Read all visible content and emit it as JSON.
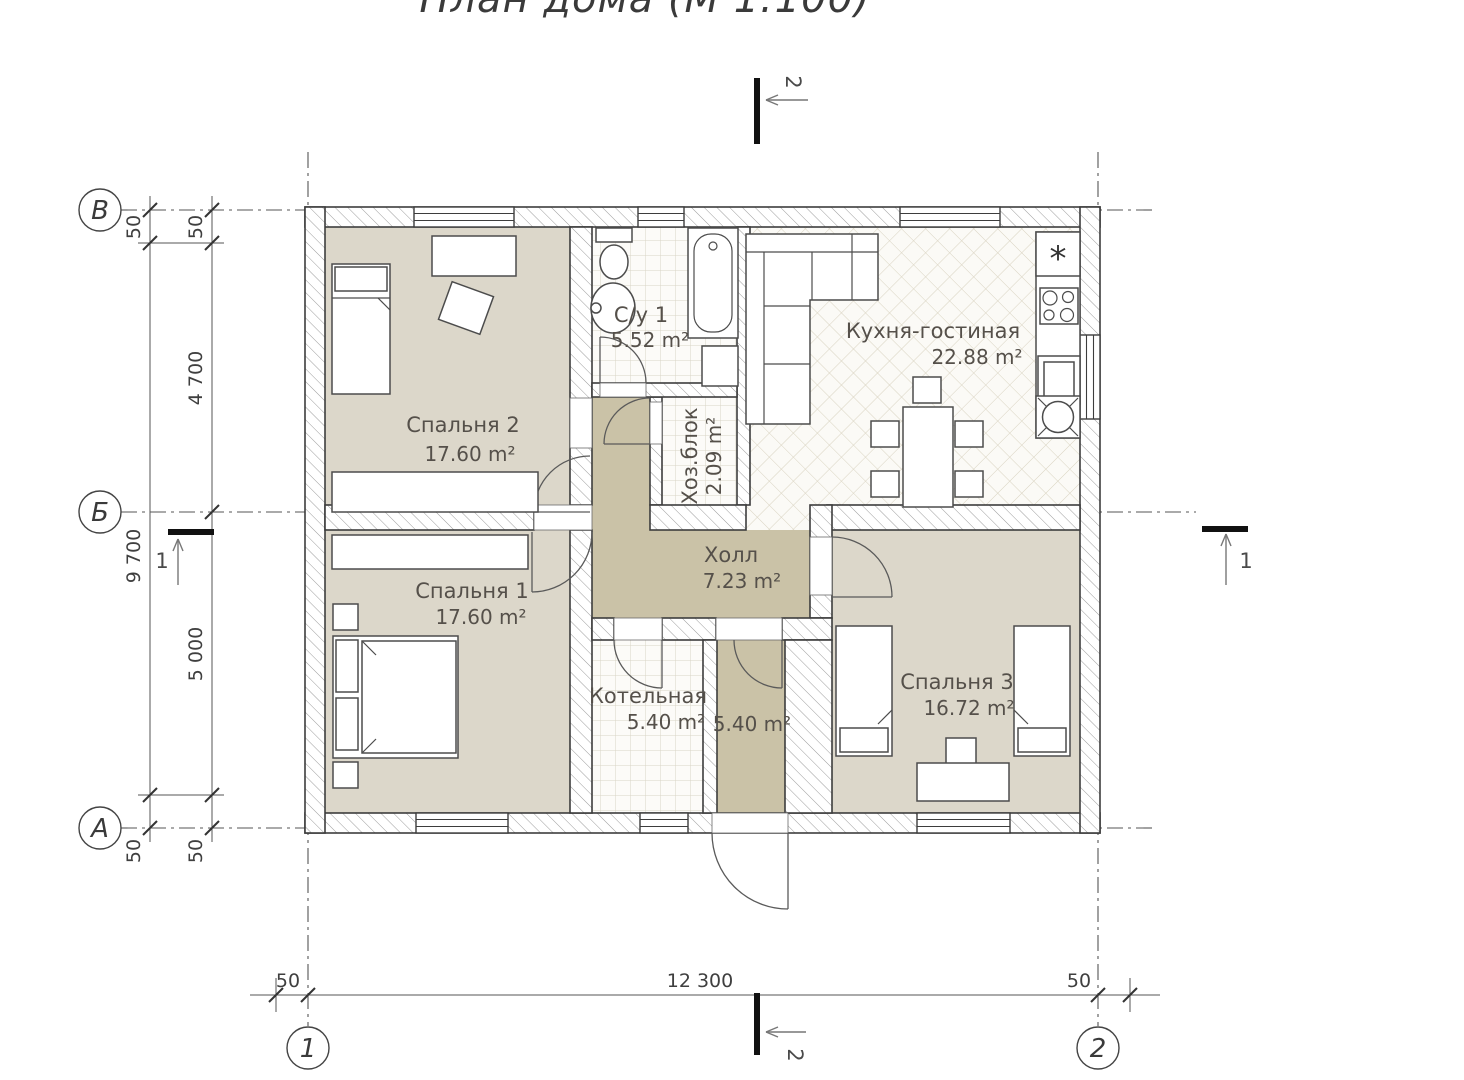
{
  "title": "План дома (М 1:100)",
  "axes": {
    "row_top": "В",
    "row_mid": "Б",
    "row_bottom": "А",
    "col_left": "1",
    "col_right": "2"
  },
  "sections": {
    "cut1": "1",
    "cut2": "2"
  },
  "dimensions": {
    "left_inner_top": "50",
    "left_inner_upper": "4 700",
    "left_inner_lower": "5 000",
    "left_inner_bottom": "50",
    "left_outer_top": "50",
    "left_outer_total": "9 700",
    "left_outer_bottom": "50",
    "bottom_left": "50",
    "bottom_total": "12 300",
    "bottom_right": "50"
  },
  "rooms": [
    {
      "name": "Спальня 2",
      "area": "17.60 m²"
    },
    {
      "name": "С/у 1",
      "area": "5.52 m²"
    },
    {
      "name": "Хоз.блок",
      "area": "2.09 m²"
    },
    {
      "name": "Кухня-гостиная",
      "area": "22.88 m²"
    },
    {
      "name": "Холл",
      "area": "7.23 m²"
    },
    {
      "name": "Спальня 1",
      "area": "17.60 m²"
    },
    {
      "name": "Котельная",
      "area": "5.40 m²"
    },
    {
      "name": "",
      "area": "5.40 m²"
    },
    {
      "name": "Спальня 3",
      "area": "16.72 m²"
    }
  ],
  "icons": {
    "fridge_symbol": "*"
  },
  "colors": {
    "room_beige": "#dcd7ca",
    "hall_khaki": "#cac2a7",
    "wall_line": "#3d3d3d",
    "hatch_line": "#9c9c9c",
    "tile_line": "#d9d4c6",
    "diamond_line": "#d9d3c1"
  }
}
